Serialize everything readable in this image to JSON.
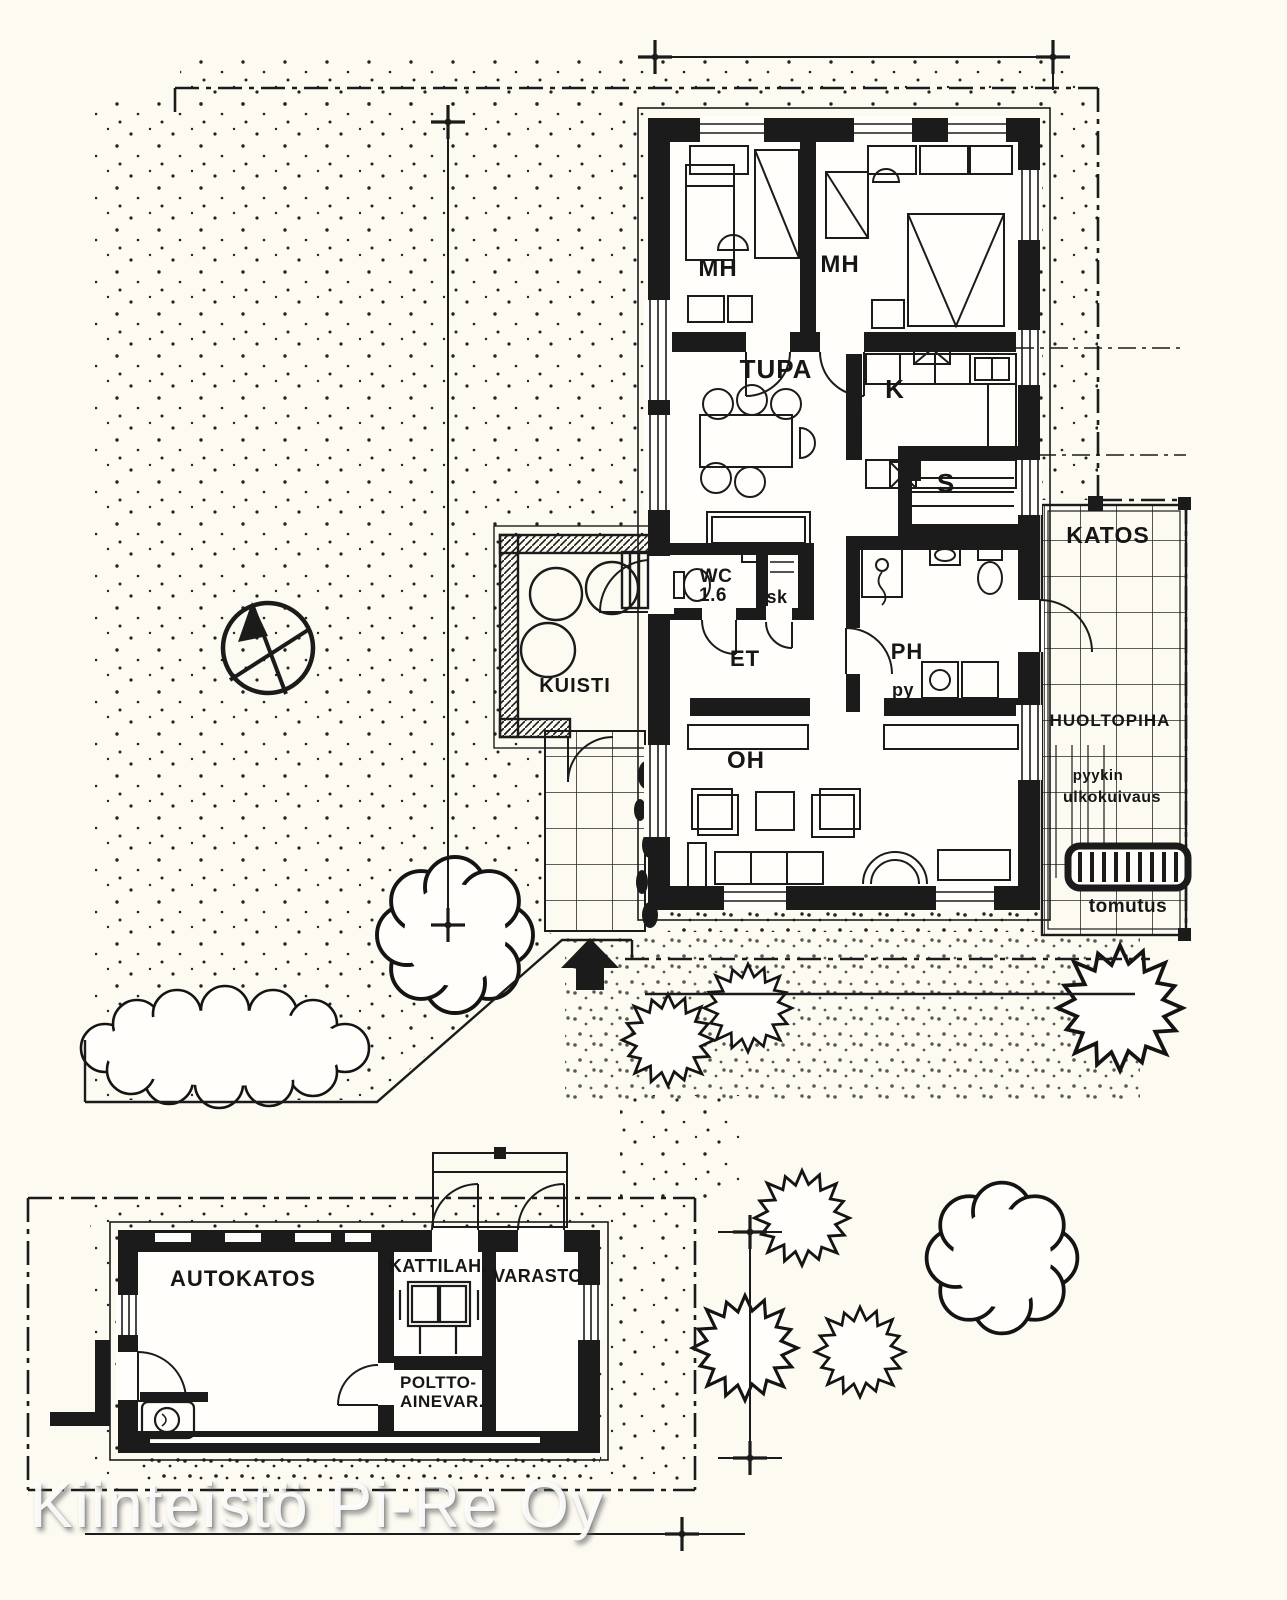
{
  "meta": {
    "type": "floor-plan-site-drawing",
    "colors": {
      "paper": "#fcfaf1",
      "ink": "#1b1b1b",
      "room_floor": "#fffefb"
    }
  },
  "watermark": {
    "text": "Kiinteistö Pi-Re Oy"
  },
  "house": {
    "rooms": {
      "bedroom1": "MH",
      "bedroom2": "MH",
      "tupa": "TUPA",
      "kitchen": "K",
      "sauna": "S",
      "wc": "WC",
      "wc_area": "1.6",
      "closet": "sk",
      "entry": "ET",
      "washroom": "PH",
      "laundry": "py",
      "porch": "KUISTI",
      "living": "OH"
    }
  },
  "yard": {
    "canopy": "KATOS",
    "service_yard": "HUOLTOPIHA",
    "drying1": "pyykin",
    "drying2": "ulkokuivaus",
    "carpet_rack": "tomutus"
  },
  "outbuilding": {
    "carport": "AUTOKATOS",
    "boiler": "KATTILAH.",
    "storage": "VARASTO",
    "fuel1": "POLTTO-",
    "fuel2": "AINEVAR."
  }
}
